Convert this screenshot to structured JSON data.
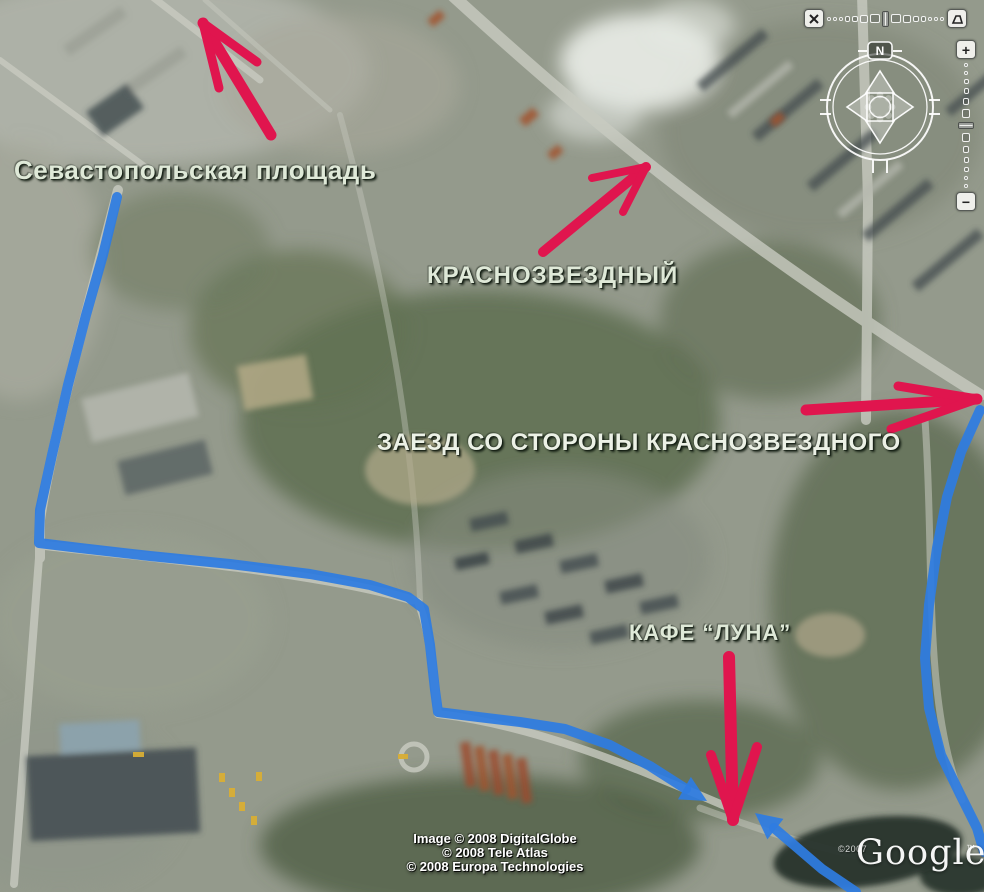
{
  "map": {
    "labels": [
      {
        "id": "sevastopolskaya",
        "text": "Севастопольская площадь"
      },
      {
        "id": "krasnozvezdny",
        "text": "КРАСНОЗВЕЗДНЫЙ"
      },
      {
        "id": "zaezd",
        "text": "ЗАЕЗД СО СТОРОНЫ КРАСНОЗВЕЗДНОГО"
      },
      {
        "id": "cafe-luna",
        "text": "КАФЕ “ЛУНА”"
      }
    ],
    "attribution": {
      "line1": "Image © 2008 DigitalGlobe",
      "line2": "© 2008 Tele Atlas",
      "line3": "© 2008 Europa Technologies"
    },
    "watermark": {
      "copyright": "©2007",
      "logo": "Google",
      "tm": "™"
    }
  },
  "controls": {
    "compass_north": "N",
    "zoom_in": "+",
    "zoom_out": "−"
  },
  "overlay": {
    "route_color": "#2e7ce1",
    "arrow_color": "#e0154e",
    "routes": [
      {
        "name": "route-from-sevastopolskaya",
        "width": 10,
        "points": [
          [
            117,
            197
          ],
          [
            103,
            255
          ],
          [
            86,
            315
          ],
          [
            68,
            385
          ],
          [
            52,
            455
          ],
          [
            40,
            510
          ],
          [
            39,
            543
          ],
          [
            80,
            548
          ],
          [
            150,
            556
          ],
          [
            230,
            564
          ],
          [
            310,
            574
          ],
          [
            370,
            585
          ],
          [
            408,
            597
          ],
          [
            424,
            609
          ],
          [
            430,
            645
          ],
          [
            435,
            690
          ],
          [
            438,
            712
          ],
          [
            470,
            716
          ],
          [
            520,
            722
          ],
          [
            565,
            729
          ],
          [
            610,
            745
          ],
          [
            650,
            766
          ],
          [
            686,
            789
          ]
        ],
        "head": [
          707,
          801
        ]
      },
      {
        "name": "route-right-side",
        "width": 10,
        "points": [
          [
            980,
            410
          ],
          [
            961,
            452
          ],
          [
            947,
            497
          ],
          [
            937,
            548
          ],
          [
            929,
            605
          ],
          [
            925,
            658
          ],
          [
            929,
            708
          ],
          [
            941,
            755
          ],
          [
            960,
            794
          ],
          [
            977,
            828
          ],
          [
            984,
            852
          ]
        ],
        "head": null
      },
      {
        "name": "route-right-bottom",
        "width": 10,
        "points": [
          [
            856,
            892
          ],
          [
            822,
            869
          ],
          [
            794,
            845
          ],
          [
            774,
            828
          ]
        ],
        "head": [
          755,
          813
        ]
      }
    ],
    "pink_arrows": [
      {
        "name": "arrow-to-sevastopolskaya",
        "width": 11,
        "tail": [
          271,
          135
        ],
        "tip": [
          203,
          23
        ],
        "barbs": [
          [
            257,
            62
          ],
          [
            219,
            88
          ]
        ]
      },
      {
        "name": "arrow-krasnozvezdny",
        "width": 10,
        "tail": [
          543,
          252
        ],
        "tip": [
          646,
          167
        ],
        "barbs": [
          [
            592,
            178
          ],
          [
            623,
            212
          ]
        ]
      },
      {
        "name": "arrow-zaezd",
        "width": 11,
        "tail": [
          806,
          410
        ],
        "tip": [
          977,
          399
        ],
        "barbs": [
          [
            898,
            386
          ],
          [
            891,
            429
          ]
        ]
      },
      {
        "name": "arrow-cafe-luna",
        "width": 12,
        "tail": [
          729,
          657
        ],
        "tip": [
          733,
          820
        ],
        "barbs": [
          [
            711,
            755
          ],
          [
            757,
            747
          ]
        ]
      }
    ]
  }
}
